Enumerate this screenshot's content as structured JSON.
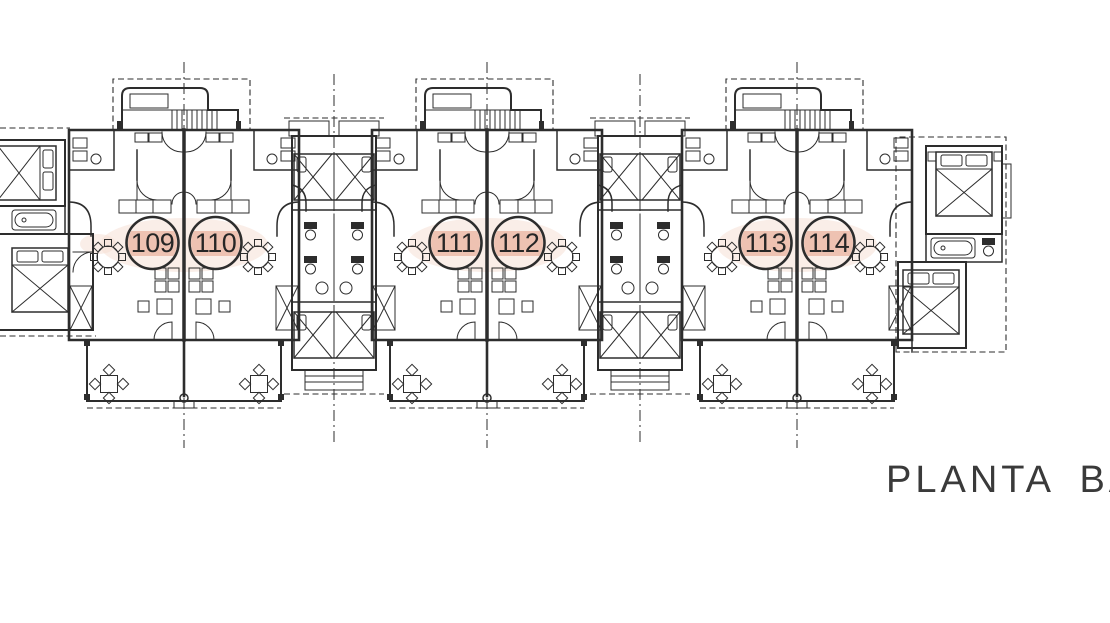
{
  "caption": {
    "label": "PLANTA BA"
  },
  "units": [
    {
      "label": "109"
    },
    {
      "label": "110"
    },
    {
      "label": "111"
    },
    {
      "label": "112"
    },
    {
      "label": "113"
    },
    {
      "label": "114"
    }
  ],
  "colors": {
    "ink": "#2d2d2d",
    "paper": "#ffffff",
    "unit_highlight": "#eec2b2",
    "blush": "#f6ddd2",
    "caption_ink": "#3a3a3a"
  }
}
